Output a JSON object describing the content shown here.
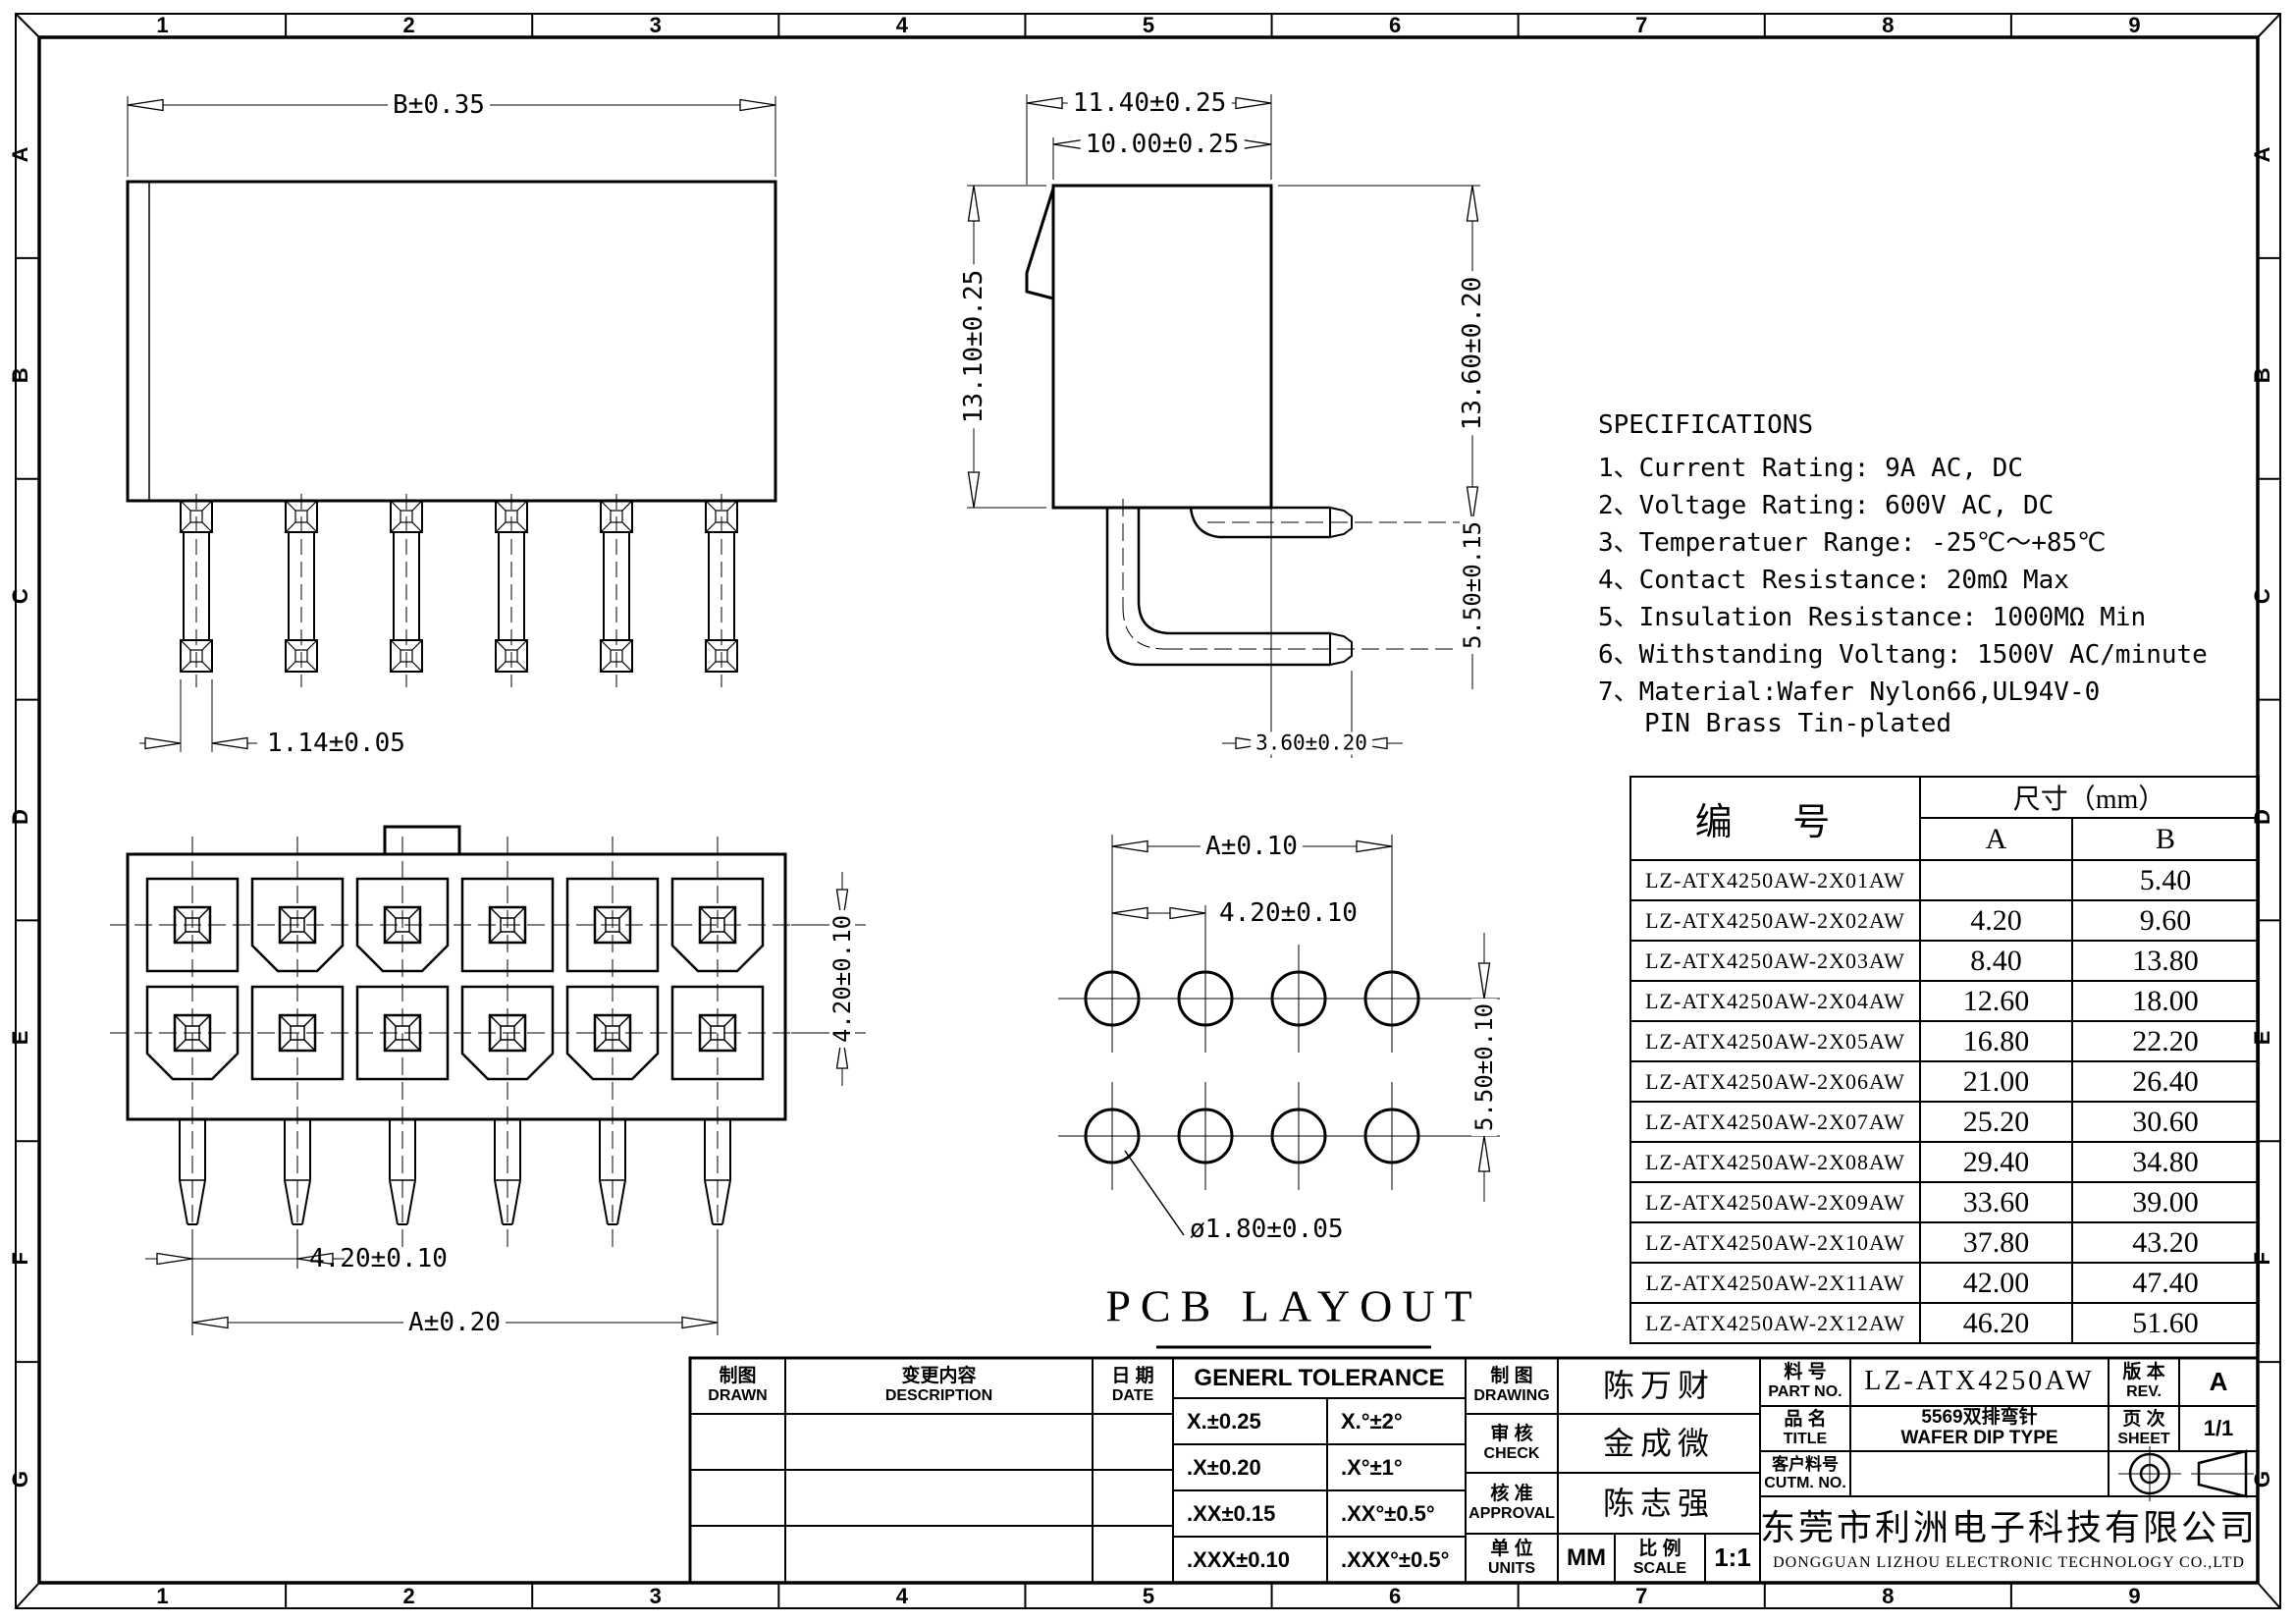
{
  "sheet": {
    "zones_h": [
      "1",
      "2",
      "3",
      "4",
      "5",
      "6",
      "7",
      "8",
      "9"
    ],
    "zones_v": [
      "A",
      "B",
      "C",
      "D",
      "E",
      "F",
      "G"
    ]
  },
  "dims": {
    "top_width": "B±0.35",
    "top_pin": "1.14±0.05",
    "side_total": "11.40±0.25",
    "side_body": "10.00±0.25",
    "side_height": "13.10±0.25",
    "side_pin_h": "13.60±0.20",
    "side_pitch": "5.50±0.15",
    "side_tail": "3.60±0.20",
    "front_pitch_x": "4.20±0.10",
    "front_total": "A±0.20",
    "front_pitch_y": "4.20±0.10",
    "pcb_total": "A±0.10",
    "pcb_pitch": "4.20±0.10",
    "pcb_row": "5.50±0.10",
    "pcb_hole": "ø1.80±0.05",
    "pcb_title": "PCB LAYOUT"
  },
  "specifications": {
    "title": "SPECIFICATIONS",
    "items": [
      "1、Current Rating: 9A AC, DC",
      "2、Voltage Rating: 600V AC, DC",
      "3、Temperatuer Range: -25℃～+85℃",
      "4、Contact Resistance: 20mΩ Max",
      "5、Insulation Resistance: 1000MΩ Min",
      "6、Withstanding Voltang: 1500V AC/minute",
      "7、Material:Wafer Nylon66,UL94V-0",
      "   PIN Brass Tin-plated"
    ]
  },
  "parts_table": {
    "header_part": "编  号",
    "header_size": "尺寸（mm）",
    "header_a": "A",
    "header_b": "B",
    "rows": [
      {
        "part": "LZ-ATX4250AW-2X01AW",
        "a": "",
        "b": "5.40"
      },
      {
        "part": "LZ-ATX4250AW-2X02AW",
        "a": "4.20",
        "b": "9.60"
      },
      {
        "part": "LZ-ATX4250AW-2X03AW",
        "a": "8.40",
        "b": "13.80"
      },
      {
        "part": "LZ-ATX4250AW-2X04AW",
        "a": "12.60",
        "b": "18.00"
      },
      {
        "part": "LZ-ATX4250AW-2X05AW",
        "a": "16.80",
        "b": "22.20"
      },
      {
        "part": "LZ-ATX4250AW-2X06AW",
        "a": "21.00",
        "b": "26.40"
      },
      {
        "part": "LZ-ATX4250AW-2X07AW",
        "a": "25.20",
        "b": "30.60"
      },
      {
        "part": "LZ-ATX4250AW-2X08AW",
        "a": "29.40",
        "b": "34.80"
      },
      {
        "part": "LZ-ATX4250AW-2X09AW",
        "a": "33.60",
        "b": "39.00"
      },
      {
        "part": "LZ-ATX4250AW-2X10AW",
        "a": "37.80",
        "b": "43.20"
      },
      {
        "part": "LZ-ATX4250AW-2X11AW",
        "a": "42.00",
        "b": "47.40"
      },
      {
        "part": "LZ-ATX4250AW-2X12AW",
        "a": "46.20",
        "b": "51.60"
      }
    ]
  },
  "title_block": {
    "revision": {
      "drawn_cn": "制图",
      "drawn_en": "DRAWN",
      "desc_cn": "变更内容",
      "desc_en": "DESCRIPTION",
      "date_cn": "日 期",
      "date_en": "DATE"
    },
    "tolerance": {
      "title": "GENERL TOLERANCE",
      "rows": [
        [
          "X.±0.25",
          "X.°±2°"
        ],
        [
          ".X±0.20",
          ".X°±1°"
        ],
        [
          ".XX±0.15",
          ".XX°±0.5°"
        ],
        [
          ".XXX±0.10",
          ".XXX°±0.5°"
        ]
      ]
    },
    "approvals": {
      "drawing_cn": "制 图",
      "drawing_en": "DRAWING",
      "drawing_name": "陈万财",
      "check_cn": "审 核",
      "check_en": "CHECK",
      "check_name": "金成微",
      "approval_cn": "核 准",
      "approval_en": "APPROVAL",
      "approval_name": "陈志强",
      "units_cn": "单 位",
      "units_en": "UNITS",
      "units_value": "MM",
      "scale_cn": "比 例",
      "scale_en": "SCALE",
      "scale_value": "1:1"
    },
    "info": {
      "part_no_cn": "料 号",
      "part_no_en": "PART NO.",
      "part_no": "LZ-ATX4250AW",
      "title_cn": "品 名",
      "title_en": "TITLE",
      "title_line1": "5569双排弯针",
      "title_line2": "WAFER DIP TYPE",
      "cust_cn": "客户料号",
      "cust_en": "CUTM. NO.",
      "rev_cn": "版 本",
      "rev_en": "REV.",
      "rev": "A",
      "sheet_cn": "页 次",
      "sheet_en": "SHEET",
      "sheet": "1/1",
      "company_cn": "东莞市利洲电子科技有限公司",
      "company_en": "DONGGUAN LIZHOU ELECTRONIC TECHNOLOGY CO.,LTD"
    }
  }
}
